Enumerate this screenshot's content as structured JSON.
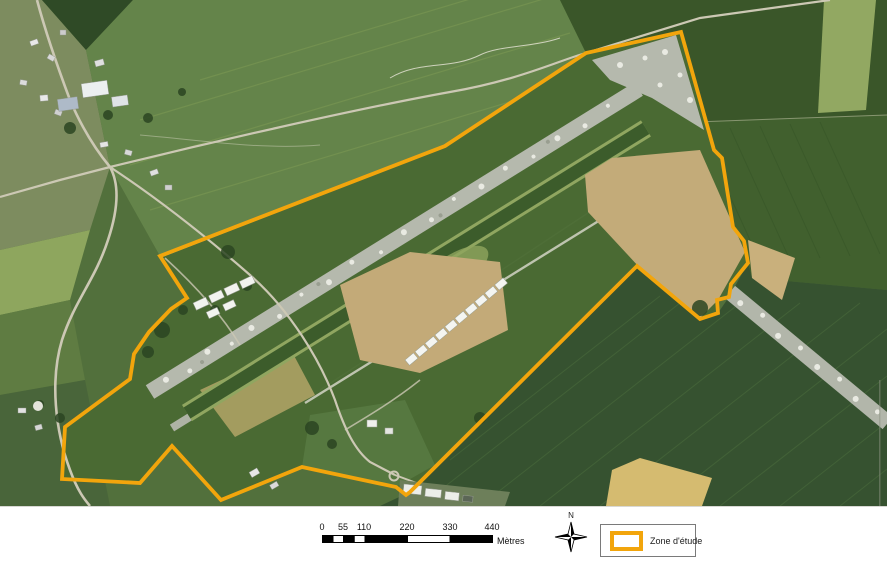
{
  "map": {
    "zone_polygon_points": "681,32 714,150 722,158 733,227 744,241 748,263 731,284 729,297 717,300 718,313 700,319 637,266 410,492 406,495 396,487 302,467 221,500 172,446 140,483 62,479 65,427 130,379 134,354 149,332 171,309 187,298 160,256 445,146 586,53",
    "zone_color": "#F2A50C"
  },
  "scalebar": {
    "labels": [
      "0",
      "55",
      "110",
      "220",
      "330",
      "440"
    ],
    "unit_label": "Mètres"
  },
  "north_arrow": {
    "label": "N"
  },
  "legend": {
    "items": [
      {
        "label": "Zone d'étude",
        "swatch_color": "#F2A50C"
      }
    ]
  }
}
